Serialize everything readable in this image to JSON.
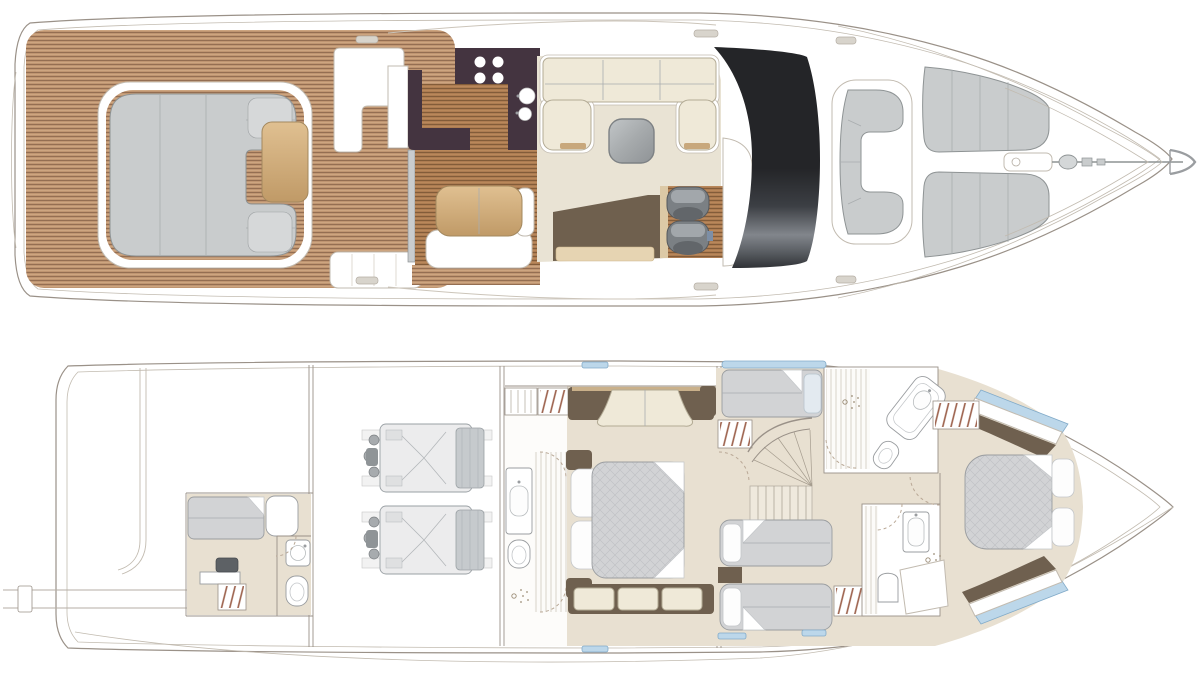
{
  "title": "Motor yacht deck plans",
  "decks": [
    {
      "id": "main-deck",
      "name": "main-deck-plan",
      "regions": [
        "aft-cockpit",
        "cockpit-seating",
        "cockpit-table",
        "wet-bar",
        "sliding-door",
        "galley",
        "dinette",
        "saloon",
        "saloon-coffee-table",
        "helm-seats",
        "helm-console",
        "windshield",
        "foredeck-seating",
        "bow-sunpads",
        "anchor-windlass"
      ]
    },
    {
      "id": "lower-deck",
      "name": "lower-deck-plan",
      "regions": [
        "swim-platform",
        "tender-garage",
        "crew-cabin",
        "crew-bathroom",
        "engine-room",
        "port-engine",
        "starboard-engine",
        "master-bathroom",
        "master-cabin",
        "staircase",
        "guest-cabin-single",
        "guest-cabin-twin",
        "day-head",
        "ensuite-bathroom",
        "vip-cabin"
      ]
    }
  ],
  "colors": {
    "paper": "#ffffff",
    "hullStroke": "#9a9188",
    "hullInner": "#c2bbb0",
    "teakBase": "#bf9571",
    "teakLine": "#8f6a4e",
    "teakLight": "#d3ac86",
    "woodBase": "#ad7c52",
    "woodLine": "#7d5836",
    "creamFloor": "#e9e3d4",
    "sofaCream": "#efe9d8",
    "sofaStroke": "#b3ab95",
    "counterDark": "#443440",
    "carpetBrown": "#6f604e",
    "rugTan": "#e6d4b2",
    "tanTableLight": "#e0c091",
    "tanTableDark": "#c09a67",
    "tanTrim": "#c8a87c",
    "seatGray": "#c9cccd",
    "seatStroke": "#8e9394",
    "seamGray": "#a9adaf",
    "helmSeatDark": "#7b8084",
    "helmSeatLight": "#a2a7ab",
    "windshieldDark": "#242528",
    "windshieldLight": "#82868c",
    "metalLight": "#c2c6c8",
    "metalDark": "#8f9396",
    "floorBeige": "#e8e0d1",
    "mattressGray": "#d2d3d5",
    "mattressStroke": "#9a9da0",
    "quiltLine": "#bec0c3",
    "pillowWhite": "#fdfdfd",
    "pillowBlue": "#e3eaf0",
    "darkWood": "#6f604f",
    "glassBlue": "#bcd7ea",
    "glassStroke": "#82abc9",
    "hangerRust": "#9b5f4a",
    "fixtureStroke": "#9a9da0",
    "stripeGlass": "#cfc9bd",
    "dashTan": "#b9a896",
    "engineBody": "#ececed",
    "engineDetail": "#9aa0a4",
    "engineDark": "#8f9497",
    "consoleBlue": "#7d8fa6"
  }
}
